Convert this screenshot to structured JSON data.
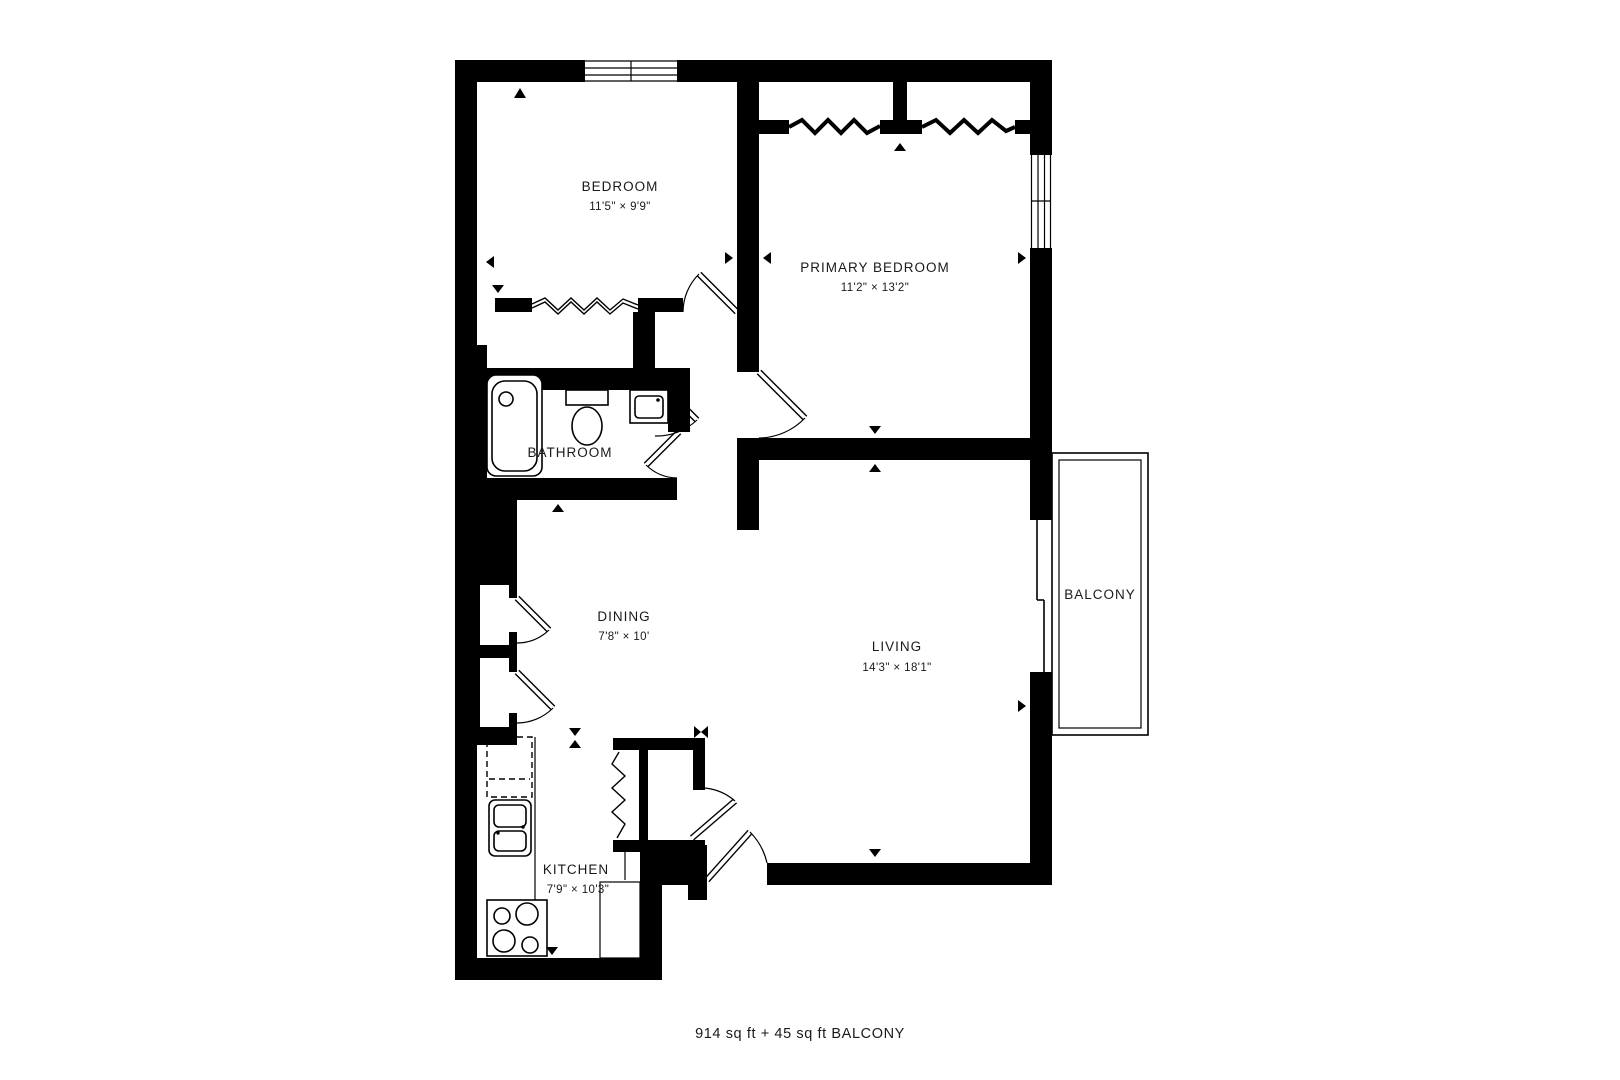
{
  "title": "Apartment floor plan",
  "rooms": [
    {
      "id": "bedroom",
      "name": "BEDROOM",
      "dimensions": "11'5\" × 9'9\""
    },
    {
      "id": "primary-bedroom",
      "name": "PRIMARY BEDROOM",
      "dimensions": "11'2\" × 13'2\""
    },
    {
      "id": "bathroom",
      "name": "BATHROOM",
      "dimensions": ""
    },
    {
      "id": "dining",
      "name": "DINING",
      "dimensions": "7'8\" × 10'"
    },
    {
      "id": "living",
      "name": "LIVING",
      "dimensions": "14'3\" × 18'1\""
    },
    {
      "id": "kitchen",
      "name": "KITCHEN",
      "dimensions": "7'9\" × 10'3\""
    },
    {
      "id": "balcony",
      "name": "BALCONY",
      "dimensions": ""
    }
  ],
  "footer": {
    "area_label": "914 sq ft + 45 sq ft BALCONY"
  },
  "fixtures": [
    "bathtub",
    "toilet",
    "bathroom-sink",
    "refrigerator",
    "kitchen-sink",
    "stove",
    "counter",
    "peninsula-counter"
  ],
  "symbols": [
    "window",
    "sliding-door",
    "door-swing",
    "closet-rod-zigzag",
    "direction-marker"
  ],
  "colors": {
    "wall": "#000000",
    "background": "#ffffff",
    "text": "#1a1a1a"
  }
}
